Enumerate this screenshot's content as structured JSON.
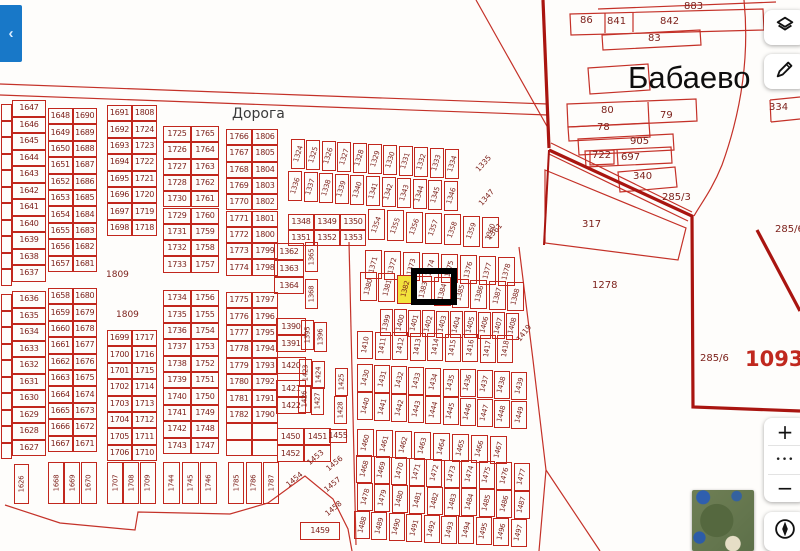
{
  "controls": {
    "collapse_icon": "‹",
    "zoom_in": "+",
    "more": "•••",
    "zoom_out": "−"
  },
  "colors": {
    "parcel_line": "#c1271d",
    "parcel_text": "#7d221c",
    "boundary": "#a91510",
    "highlight": "#f2e23c",
    "selection": "#000000",
    "accent_blue": "#1878c8"
  },
  "map": {
    "highlighted_parcel": "1382",
    "selection": {
      "x": 411,
      "y": 268,
      "w": 46,
      "h": 37
    },
    "grids": [
      {
        "x": 1,
        "y": 104,
        "w": 11,
        "h": 16.5,
        "cols": [
          [
            "",
            "",
            "",
            "",
            "",
            "",
            "",
            "",
            "",
            "",
            ""
          ]
        ]
      },
      {
        "x": 1,
        "y": 294,
        "w": 11,
        "h": 16.5,
        "cols": [
          [
            "",
            "",
            "",
            "",
            "",
            "",
            "",
            "",
            "",
            ""
          ]
        ]
      },
      {
        "x": 12,
        "y": 100,
        "w": 34,
        "h": 16.5,
        "cols": [
          [
            "1647",
            "1646",
            "1645",
            "1644",
            "1643",
            "1642",
            "1641",
            "1640",
            "1639",
            "1638",
            "1637"
          ]
        ]
      },
      {
        "x": 12,
        "y": 291,
        "w": 34,
        "h": 16.5,
        "cols": [
          [
            "1636",
            "1635",
            "1634",
            "1633",
            "1632",
            "1631",
            "1630",
            "1629",
            "1628",
            "1627"
          ]
        ]
      },
      {
        "x": 48,
        "y": 108,
        "w": 24.5,
        "h": 16.4,
        "cols": [
          [
            "1648",
            "1649",
            "1650",
            "1651",
            "1652",
            "1653",
            "1654",
            "1655",
            "1656",
            "1657"
          ],
          [
            "1690",
            "1689",
            "1688",
            "1687",
            "1686",
            "1685",
            "1684",
            "1683",
            "1682",
            "1681"
          ]
        ]
      },
      {
        "x": 48,
        "y": 288,
        "w": 24.5,
        "h": 16.4,
        "cols": [
          [
            "1658",
            "1659",
            "1660",
            "1661",
            "1662",
            "1663",
            "1664",
            "1665",
            "1666",
            "1667"
          ],
          [
            "1680",
            "1679",
            "1678",
            "1677",
            "1676",
            "1675",
            "1674",
            "1673",
            "1672",
            "1671"
          ]
        ]
      },
      {
        "x": 107,
        "y": 105,
        "w": 25,
        "h": 16.4,
        "cols": [
          [
            "1691",
            "1692",
            "1693",
            "1694",
            "1695",
            "1696",
            "1697",
            "1698"
          ],
          [
            "1808",
            "1724",
            "1723",
            "1722",
            "1721",
            "1720",
            "1719",
            "1718"
          ]
        ]
      },
      {
        "x": 107,
        "y": 330,
        "w": 25,
        "h": 16.4,
        "cols": [
          [
            "1699",
            "1700",
            "1701",
            "1702",
            "1703",
            "1704",
            "1705",
            "1706"
          ],
          [
            "1717",
            "1716",
            "1715",
            "1714",
            "1713",
            "1712",
            "1711",
            "1710"
          ]
        ]
      },
      {
        "x": 163,
        "y": 126,
        "w": 28,
        "h": 16.3,
        "cols": [
          [
            "1725",
            "1726",
            "1727",
            "1728",
            "1730",
            "1729",
            "1731",
            "1732",
            "1733"
          ],
          [
            "1765",
            "1764",
            "1763",
            "1762",
            "1761",
            "1760",
            "1759",
            "1758",
            "1757"
          ]
        ]
      },
      {
        "x": 163,
        "y": 290,
        "w": 28,
        "h": 16.4,
        "cols": [
          [
            "1734",
            "1735",
            "1736",
            "1737",
            "1738",
            "1739",
            "1740",
            "1741",
            "1742",
            "1743"
          ],
          [
            "1756",
            "1755",
            "1754",
            "1753",
            "1752",
            "1751",
            "1750",
            "1749",
            "1748",
            "1747"
          ]
        ]
      },
      {
        "x": 226,
        "y": 129,
        "w": 26,
        "h": 16.3,
        "cols": [
          [
            "1766",
            "1767",
            "1768",
            "1769",
            "1770",
            "1771",
            "1772",
            "1773",
            "1774"
          ],
          [
            "1806",
            "1805",
            "1804",
            "1803",
            "1802",
            "1801",
            "1800",
            "1799",
            "1798"
          ]
        ]
      },
      {
        "x": 226,
        "y": 292,
        "w": 26,
        "h": 16.4,
        "cols": [
          [
            "1775",
            "1776",
            "1777",
            "1778",
            "1779",
            "1780",
            "1781",
            "1782",
            "",
            ""
          ],
          [
            "1797",
            "1796",
            "1795",
            "1794",
            "1793",
            "1792",
            "1791",
            "1790",
            "",
            ""
          ]
        ]
      },
      {
        "x": 288,
        "y": 214,
        "w": 26,
        "h": 16,
        "cols": [
          [
            "1348",
            "1351"
          ],
          [
            "1349",
            "1352"
          ],
          [
            "1350",
            "1353"
          ]
        ]
      },
      {
        "x": 274,
        "y": 243,
        "w": 30,
        "h": 17,
        "cols": [
          [
            "1362",
            "1363",
            "1364"
          ]
        ]
      },
      {
        "x": 276,
        "y": 318,
        "w": 30,
        "h": 17,
        "cols": [
          [
            "1390",
            "1391"
          ]
        ]
      },
      {
        "x": 276,
        "y": 357,
        "w": 30,
        "h": 17,
        "cols": [
          [
            "1420"
          ]
        ]
      },
      {
        "x": 276,
        "y": 380,
        "w": 30,
        "h": 17,
        "cols": [
          [
            "1421",
            "1422"
          ]
        ]
      },
      {
        "x": 277,
        "y": 428,
        "w": 27,
        "h": 17,
        "cols": [
          [
            "1450",
            "1452"
          ],
          [
            "1451",
            ""
          ]
        ]
      },
      {
        "x": 329,
        "y": 429,
        "w": 18,
        "h": 14,
        "cols": [
          [
            "1455"
          ]
        ]
      },
      {
        "x": 300,
        "y": 522,
        "w": 40,
        "h": 18,
        "cols": [
          [
            "1459"
          ]
        ]
      }
    ],
    "rot_rows": [
      {
        "x": 291,
        "y": 139,
        "step": 15.4,
        "dy": 1.0,
        "w": 14,
        "h": 30,
        "rot": -73,
        "values": [
          "1324",
          "1325",
          "1326",
          "1327",
          "1328",
          "1329",
          "1330",
          "1331",
          "1332",
          "1333",
          "1334"
        ]
      },
      {
        "x": 288,
        "y": 171,
        "step": 15.6,
        "dy": 1.0,
        "w": 14,
        "h": 30,
        "rot": -73,
        "values": [
          "1336",
          "1337",
          "1338",
          "1339",
          "1340",
          "1341",
          "1342",
          "1343",
          "1344",
          "1345",
          "1346"
        ]
      },
      {
        "x": 368,
        "y": 209,
        "step": 19,
        "dy": 1.3,
        "w": 17,
        "h": 31,
        "rot": -70,
        "values": [
          "1354",
          "1355",
          "1356",
          "1357",
          "1358",
          "1359",
          "1360"
        ]
      },
      {
        "x": 365,
        "y": 250,
        "step": 19,
        "dy": 1.0,
        "w": 17,
        "h": 29,
        "rot": -75,
        "values": [
          "1371",
          "1372",
          "1373",
          "1374",
          "1375",
          "1376",
          "1377",
          "1378"
        ]
      },
      {
        "x": 360,
        "y": 272,
        "step": 18.4,
        "dy": 1.3,
        "w": 17,
        "h": 29,
        "rot": -75,
        "values": [
          "1380",
          "1381",
          "1382",
          "1383",
          "1384",
          "1385",
          "1386",
          "1387",
          "1388"
        ]
      },
      {
        "x": 380,
        "y": 309,
        "step": 14,
        "dy": 0.4,
        "w": 13,
        "h": 27,
        "rot": -75,
        "values": [
          "1399",
          "1400",
          "1401",
          "1402",
          "1403",
          "1404",
          "1405",
          "1406",
          "1407",
          "1408"
        ]
      },
      {
        "x": 357,
        "y": 331,
        "step": 17.5,
        "dy": 0.5,
        "w": 16,
        "h": 28,
        "rot": -80,
        "values": [
          "1410",
          "1411",
          "1412",
          "1413",
          "1414",
          "1415",
          "1416",
          "1417",
          "1418"
        ]
      },
      {
        "x": 357,
        "y": 364,
        "step": 17.1,
        "dy": 0.9,
        "w": 16,
        "h": 28,
        "rot": -75,
        "values": [
          "1430",
          "1431",
          "1432",
          "1433",
          "1434",
          "1435",
          "1436",
          "1437",
          "1438",
          "1439"
        ]
      },
      {
        "x": 357,
        "y": 392,
        "step": 17.1,
        "dy": 1.0,
        "w": 16,
        "h": 28,
        "rot": -75,
        "values": [
          "1440",
          "1441",
          "1442",
          "1443",
          "1444",
          "1445",
          "1446",
          "1447",
          "1448",
          "1449"
        ]
      },
      {
        "x": 357,
        "y": 429,
        "step": 19,
        "dy": 1.0,
        "w": 17,
        "h": 28,
        "rot": -75,
        "values": [
          "1460",
          "1461",
          "1462",
          "1463",
          "1464",
          "1465",
          "1466",
          "1467"
        ]
      },
      {
        "x": 356,
        "y": 455,
        "step": 17.5,
        "dy": 0.9,
        "w": 16,
        "h": 28,
        "rot": -75,
        "values": [
          "1468",
          "1469",
          "1470",
          "1471",
          "1472",
          "1473",
          "1474",
          "1475",
          "1476",
          "1477"
        ]
      },
      {
        "x": 357,
        "y": 483,
        "step": 17.4,
        "dy": 0.9,
        "w": 16,
        "h": 28,
        "rot": -75,
        "values": [
          "1478",
          "1479",
          "1480",
          "1481",
          "1482",
          "1483",
          "1484",
          "1485",
          "1486",
          "1487"
        ]
      },
      {
        "x": 354,
        "y": 511,
        "step": 17.4,
        "dy": 0.9,
        "w": 16,
        "h": 28,
        "rot": -75,
        "values": [
          "1488",
          "1489",
          "1490",
          "1491",
          "1492",
          "1493",
          "1494",
          "1495",
          "1496",
          "1497"
        ]
      },
      {
        "x": 14,
        "y": 464,
        "step": 16,
        "dy": 0,
        "w": 15,
        "h": 40,
        "rot": -90,
        "values": [
          "1626"
        ]
      },
      {
        "x": 48,
        "y": 462,
        "step": 16.4,
        "dy": 0,
        "w": 16,
        "h": 42,
        "rot": -90,
        "values": [
          "1668",
          "1669",
          "1670"
        ]
      },
      {
        "x": 107,
        "y": 462,
        "step": 16.4,
        "dy": 0,
        "w": 16,
        "h": 42,
        "rot": -90,
        "values": [
          "1707",
          "1708",
          "1709"
        ]
      },
      {
        "x": 163,
        "y": 462,
        "step": 18.5,
        "dy": 0,
        "w": 17,
        "h": 42,
        "rot": -90,
        "values": [
          "1744",
          "1745",
          "1746"
        ]
      },
      {
        "x": 228,
        "y": 462,
        "step": 17.5,
        "dy": 0,
        "w": 16,
        "h": 42,
        "rot": -90,
        "values": [
          "1785",
          "1786",
          "1787"
        ]
      },
      {
        "x": 305,
        "y": 242,
        "step": 0,
        "dy": 0,
        "w": 13,
        "h": 30,
        "rot": -90,
        "values": [
          "1365"
        ]
      },
      {
        "x": 305,
        "y": 279,
        "step": 0,
        "dy": 0,
        "w": 13,
        "h": 30,
        "rot": -90,
        "values": [
          "1368"
        ]
      },
      {
        "x": 301,
        "y": 320,
        "step": 0,
        "dy": 0,
        "w": 13,
        "h": 30,
        "rot": -90,
        "values": [
          "1395"
        ]
      },
      {
        "x": 314,
        "y": 322,
        "step": 0,
        "dy": 0,
        "w": 13,
        "h": 30,
        "rot": -90,
        "values": [
          "1396"
        ]
      },
      {
        "x": 299,
        "y": 359,
        "step": 0,
        "dy": 0,
        "w": 13,
        "h": 28,
        "rot": -90,
        "values": [
          "1423"
        ]
      },
      {
        "x": 312,
        "y": 361,
        "step": 0,
        "dy": 0,
        "w": 13,
        "h": 28,
        "rot": -90,
        "values": [
          "1424"
        ]
      },
      {
        "x": 298,
        "y": 385,
        "step": 0,
        "dy": 0,
        "w": 13,
        "h": 28,
        "rot": -90,
        "values": [
          "1426"
        ]
      },
      {
        "x": 311,
        "y": 387,
        "step": 0,
        "dy": 0,
        "w": 13,
        "h": 28,
        "rot": -90,
        "values": [
          "1427"
        ]
      },
      {
        "x": 335,
        "y": 368,
        "step": 0,
        "dy": 0,
        "w": 13,
        "h": 28,
        "rot": -90,
        "values": [
          "1425"
        ]
      },
      {
        "x": 334,
        "y": 396,
        "step": 0,
        "dy": 0,
        "w": 13,
        "h": 28,
        "rot": -90,
        "values": [
          "1428"
        ]
      }
    ],
    "diag_labels": [
      {
        "t": "1335",
        "x": 477,
        "y": 166,
        "rot": -48
      },
      {
        "t": "1347",
        "x": 480,
        "y": 200,
        "rot": -48
      },
      {
        "t": "1361",
        "x": 488,
        "y": 234,
        "rot": -48
      },
      {
        "t": "1419",
        "x": 518,
        "y": 336,
        "rot": -52
      },
      {
        "t": "1453",
        "x": 308,
        "y": 459,
        "rot": -40
      },
      {
        "t": "1454",
        "x": 287,
        "y": 481,
        "rot": -40
      },
      {
        "t": "1456",
        "x": 327,
        "y": 465,
        "rot": -40
      },
      {
        "t": "1457",
        "x": 325,
        "y": 486,
        "rot": -40
      },
      {
        "t": "1458",
        "x": 326,
        "y": 510,
        "rot": -40
      }
    ],
    "labels": [
      {
        "t": "Дорога",
        "x": 232,
        "y": 106,
        "s": 14,
        "cls": "road",
        "name": "road-label"
      },
      {
        "t": "Бабаево",
        "x": 628,
        "y": 60,
        "s": 31,
        "cls": "place",
        "name": "place-name-babaevo"
      },
      {
        "t": "883",
        "x": 684,
        "y": 1,
        "s": 10
      },
      {
        "t": "86",
        "x": 580,
        "y": 15,
        "s": 10
      },
      {
        "t": "841",
        "x": 607,
        "y": 16,
        "s": 10
      },
      {
        "t": "842",
        "x": 660,
        "y": 16,
        "s": 10
      },
      {
        "t": "83",
        "x": 648,
        "y": 33,
        "s": 10
      },
      {
        "t": "80",
        "x": 601,
        "y": 105,
        "s": 10
      },
      {
        "t": "79",
        "x": 660,
        "y": 110,
        "s": 10
      },
      {
        "t": "78",
        "x": 597,
        "y": 122,
        "s": 10
      },
      {
        "t": "905",
        "x": 630,
        "y": 136,
        "s": 10
      },
      {
        "t": "722",
        "x": 592,
        "y": 150,
        "s": 10
      },
      {
        "t": "697",
        "x": 621,
        "y": 152,
        "s": 10
      },
      {
        "t": "334",
        "x": 769,
        "y": 102,
        "s": 10
      },
      {
        "t": "340",
        "x": 633,
        "y": 171,
        "s": 10
      },
      {
        "t": "285/3",
        "x": 662,
        "y": 192,
        "s": 10
      },
      {
        "t": "317",
        "x": 582,
        "y": 219,
        "s": 10
      },
      {
        "t": "1278",
        "x": 592,
        "y": 280,
        "s": 10
      },
      {
        "t": "285/6",
        "x": 775,
        "y": 224,
        "s": 10
      },
      {
        "t": "285/6",
        "x": 700,
        "y": 353,
        "s": 10
      },
      {
        "t": "10931",
        "x": 745,
        "y": 347,
        "s": 21,
        "cls": "red",
        "name": "quarter-number-10931"
      },
      {
        "t": "1809",
        "x": 106,
        "y": 270,
        "s": 9
      },
      {
        "t": "1809",
        "x": 116,
        "y": 310,
        "s": 9
      }
    ]
  }
}
